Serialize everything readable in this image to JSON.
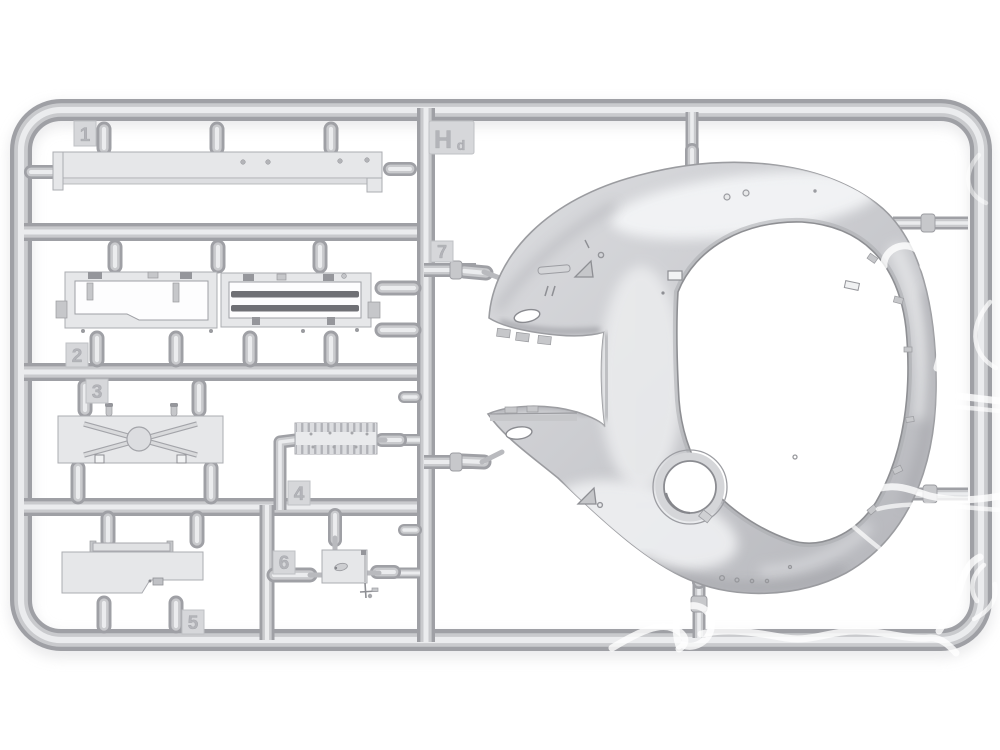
{
  "photo": {
    "alt": "Light grey injection-moulded model kit sprue frame Hd with numbered gate tabs 1-7, flat panel parts on the left and a large domed shell part with big round opening and small hatch hole on the right, white watermark squiggles over the lower right"
  },
  "sprue_code": {
    "main": "H",
    "sub": "d"
  },
  "part_tabs": [
    {
      "label": "1"
    },
    {
      "label": "2"
    },
    {
      "label": "3"
    },
    {
      "label": "4"
    },
    {
      "label": "5"
    },
    {
      "label": "6"
    },
    {
      "label": "7"
    }
  ],
  "colors": {
    "background": "#ffffff",
    "tube_outer": "#9fa0a5",
    "tube_mid": "#c9cacd",
    "tube_core": "#ebecee",
    "part_face": "#e6e7e9",
    "part_edge": "#abacb1",
    "slat_dark": "#6f7075",
    "dome_light": "#dcddDF",
    "dome_mid": "#cbccd0",
    "dome_dark": "#b3b4b9",
    "watermark": "#ffffff"
  }
}
